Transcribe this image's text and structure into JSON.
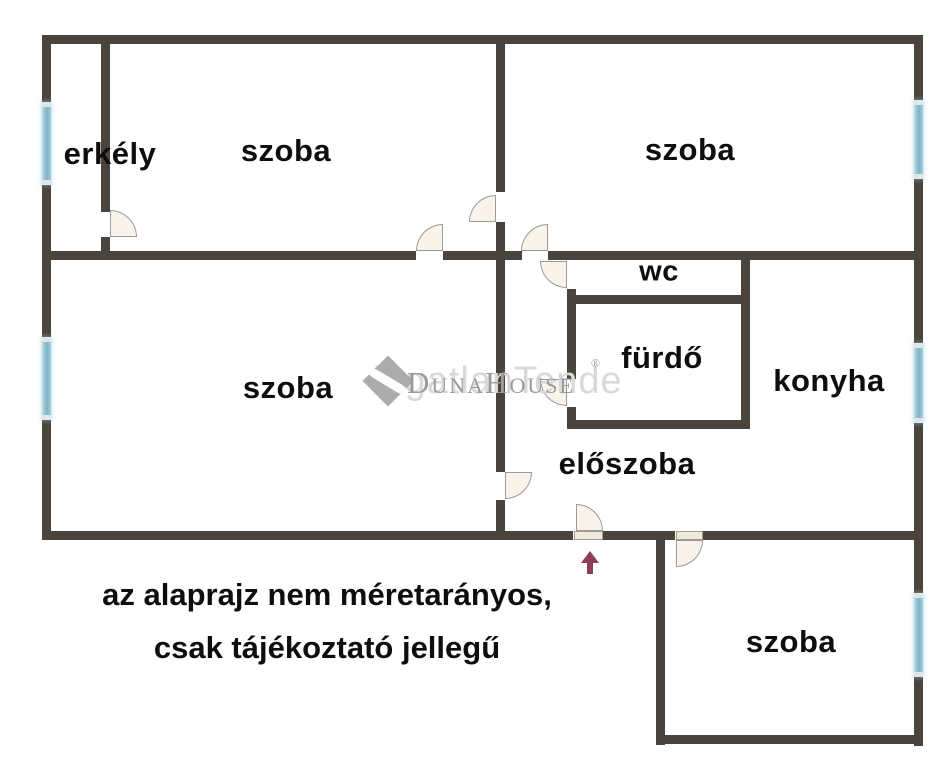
{
  "plan": {
    "width": 951,
    "height": 768,
    "colors": {
      "bg": "#ffffff",
      "wall": "#4b443c",
      "door_fill": "#faf3e9",
      "door_edge": "#9a9a9a",
      "window_cap": "#e2e6e7",
      "arrow": "#8d3f54",
      "watermark_text": "#9b9b9b",
      "watermark_echo": "#d9d9d9",
      "watermark_logo": "#acacac"
    },
    "walls": [
      [
        42,
        35,
        881,
        9
      ],
      [
        42,
        35,
        9,
        505
      ],
      [
        914,
        35,
        9,
        711
      ],
      [
        42,
        531,
        531,
        9
      ],
      [
        603,
        531,
        72,
        9
      ],
      [
        703,
        531,
        220,
        9
      ],
      [
        42,
        251,
        374,
        9
      ],
      [
        443,
        251,
        79,
        9
      ],
      [
        548,
        251,
        375,
        9
      ],
      [
        496,
        44,
        9,
        148
      ],
      [
        496,
        222,
        9,
        250
      ],
      [
        496,
        500,
        9,
        31
      ],
      [
        101,
        44,
        9,
        168
      ],
      [
        101,
        237,
        9,
        14
      ],
      [
        567,
        289,
        9,
        90
      ],
      [
        567,
        407,
        9,
        13
      ],
      [
        567,
        295,
        183,
        9
      ],
      [
        567,
        420,
        183,
        9
      ],
      [
        741,
        260,
        9,
        169
      ],
      [
        656,
        531,
        9,
        214
      ],
      [
        656,
        735,
        267,
        9
      ]
    ],
    "windows": [
      {
        "id": "balcony-window",
        "x": 42,
        "y": 102,
        "w": 9,
        "h": 83
      },
      {
        "id": "left-room-window",
        "x": 42,
        "y": 337,
        "w": 9,
        "h": 83
      },
      {
        "id": "top-right-room-window",
        "x": 914,
        "y": 100,
        "w": 9,
        "h": 79
      },
      {
        "id": "kitchen-window",
        "x": 914,
        "y": 343,
        "w": 9,
        "h": 80
      },
      {
        "id": "bottom-room-window",
        "x": 914,
        "y": 593,
        "w": 9,
        "h": 84
      }
    ],
    "thresholds": [
      {
        "id": "entrance-threshold",
        "x": 574,
        "y": 531,
        "w": 29,
        "h": 9
      },
      {
        "id": "bottom-room-threshold",
        "x": 676,
        "y": 531,
        "w": 27,
        "h": 9
      }
    ],
    "doors": [
      {
        "id": "balcony-door",
        "x": 110,
        "y": 210,
        "r": 27,
        "corner": "tr"
      },
      {
        "id": "room-to-room-door",
        "x": 469,
        "y": 195,
        "r": 27,
        "corner": "tl"
      },
      {
        "id": "top-left-room-door",
        "x": 416,
        "y": 224,
        "r": 27,
        "corner": "tl"
      },
      {
        "id": "top-right-room-door",
        "x": 521,
        "y": 224,
        "r": 27,
        "corner": "tl"
      },
      {
        "id": "wc-door",
        "x": 540,
        "y": 261,
        "r": 27,
        "corner": "bl"
      },
      {
        "id": "bathroom-door",
        "x": 540,
        "y": 379,
        "r": 27,
        "corner": "bl"
      },
      {
        "id": "left-room-door",
        "x": 505,
        "y": 472,
        "r": 27,
        "corner": "br"
      },
      {
        "id": "entrance-door",
        "x": 576,
        "y": 504,
        "r": 27,
        "corner": "tr"
      },
      {
        "id": "bottom-room-door",
        "x": 676,
        "y": 540,
        "r": 27,
        "corner": "br"
      }
    ],
    "rooms": [
      {
        "id": "erkely",
        "label": "erkély",
        "x": 110,
        "y": 154,
        "size": 31
      },
      {
        "id": "szoba-top-left",
        "label": "szoba",
        "x": 286,
        "y": 151,
        "size": 31
      },
      {
        "id": "szoba-top-right",
        "label": "szoba",
        "x": 690,
        "y": 150,
        "size": 31
      },
      {
        "id": "wc",
        "label": "wc",
        "x": 659,
        "y": 272,
        "size": 29
      },
      {
        "id": "furdo",
        "label": "fürdő",
        "x": 662,
        "y": 358,
        "size": 31
      },
      {
        "id": "konyha",
        "label": "konyha",
        "x": 829,
        "y": 381,
        "size": 31
      },
      {
        "id": "szoba-bottom-left",
        "label": "szoba",
        "x": 288,
        "y": 388,
        "size": 31
      },
      {
        "id": "eloszoba",
        "label": "előszoba",
        "x": 627,
        "y": 464,
        "size": 31
      },
      {
        "id": "szoba-bottom-right",
        "label": "szoba",
        "x": 791,
        "y": 642,
        "size": 31
      }
    ]
  },
  "watermark": {
    "text": "DunaHouse",
    "reg": "®",
    "echo": "ingatlanTende"
  },
  "entrance_arrow": {
    "x": 581,
    "y": 551
  },
  "disclaimer": {
    "line1": "az alaprajz nem méretarányos,",
    "line2": "csak tájékoztató jellegű",
    "x": 327,
    "y": 568
  }
}
